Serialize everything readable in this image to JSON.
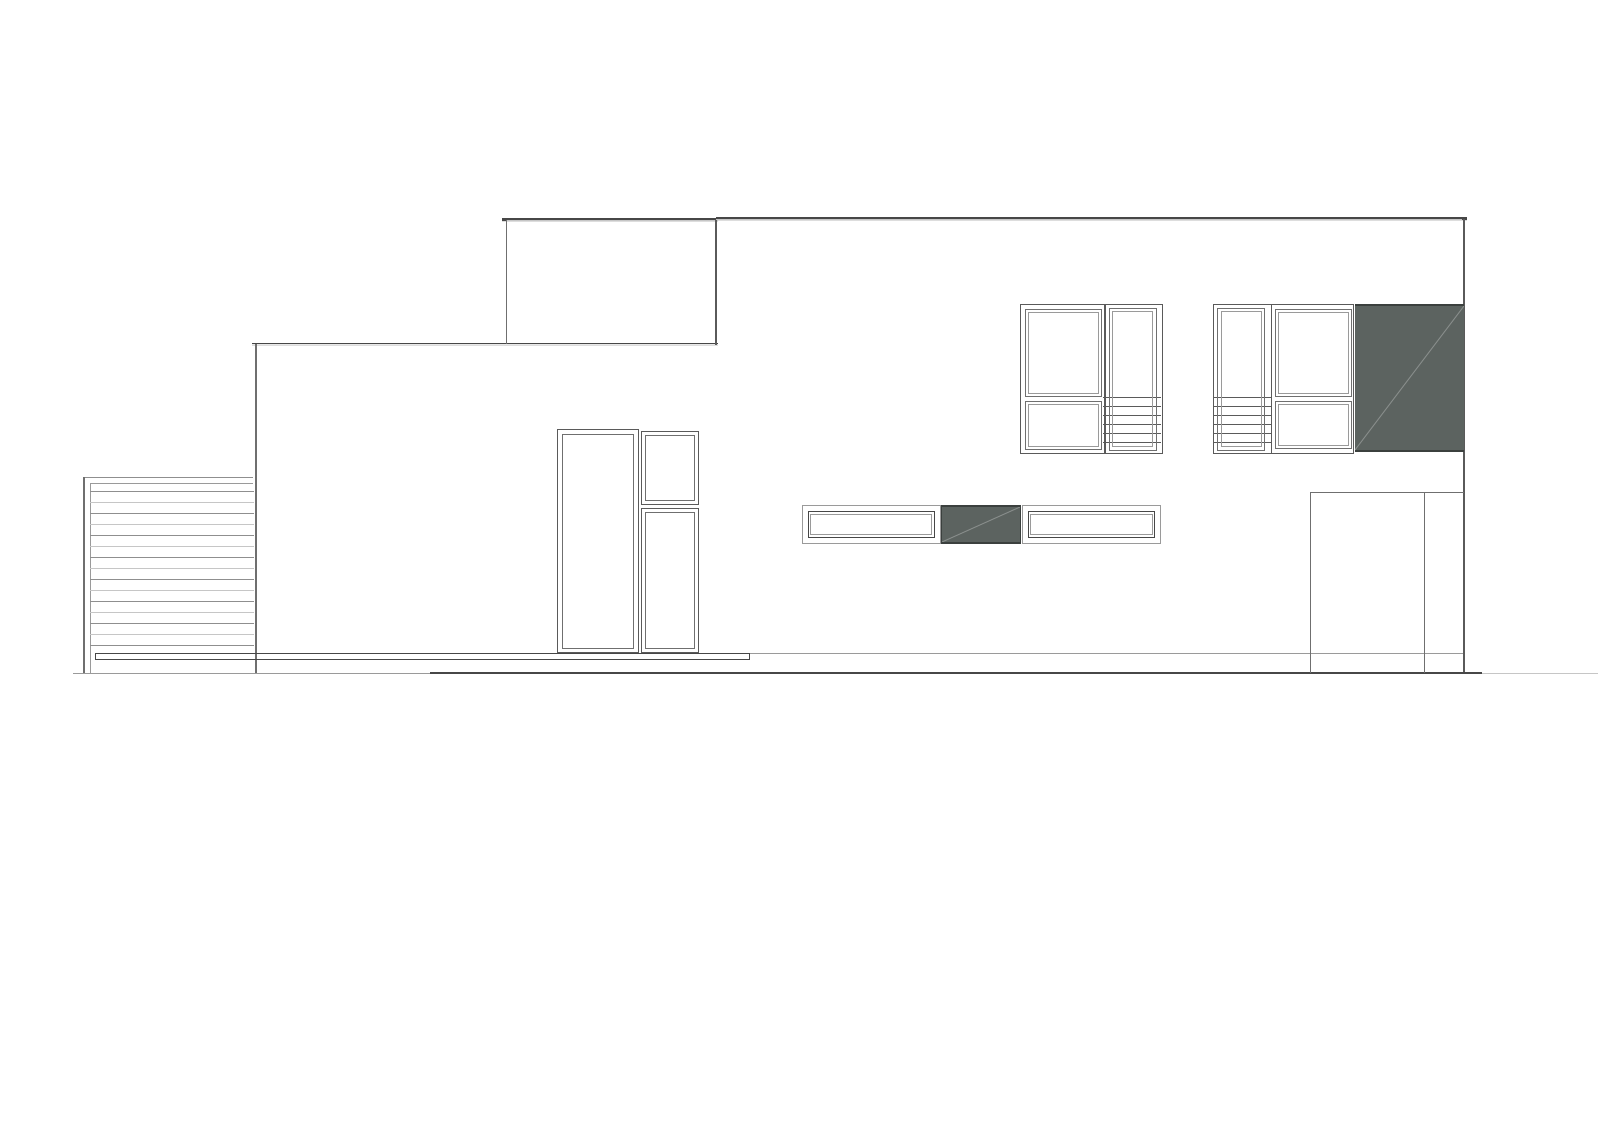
{
  "meta": {
    "kind": "architectural-elevation-drawing",
    "description": "Black-and-white side elevation of a modern flat-roof house with a raised clerestory volume, horizontal louver screen at left, stacked entry doors, strip windows, two upper window units with staircase treads visible behind glass, dark cladding panels and a garage at right",
    "visible_text": []
  },
  "palette": {
    "background": "#ffffff",
    "line_dark": "#474747",
    "line_frame": "#5a5a5a",
    "line_mid": "#6f6f6f",
    "line_light": "#9a9a9a",
    "line_light2": "#8f8f8f",
    "line_faint": "#c6c6c6",
    "panel_fill": "#5c6360",
    "panel_edge": "#3b403e",
    "panel_diagonal": "rgba(255,255,255,0.32)"
  },
  "louver": {
    "slat_count": 15,
    "slat_spacing": 11
  },
  "stairs": {
    "line_count": 6,
    "line_spacing": 9
  },
  "inventory": [
    "main-roof-line",
    "clerestory-box",
    "lower-roof-line",
    "left-wall",
    "right-wall",
    "louver-screen",
    "deck-bar",
    "floor-line",
    "ground-line",
    "entry-door",
    "entry-side-window-upper",
    "entry-side-window-lower",
    "strip-window-left",
    "strip-dark-panel",
    "strip-window-right",
    "upper-window-unit-left",
    "upper-window-unit-right",
    "stair-glazing",
    "facade-dark-panel",
    "garage-opening",
    "garage-door-leaf"
  ]
}
